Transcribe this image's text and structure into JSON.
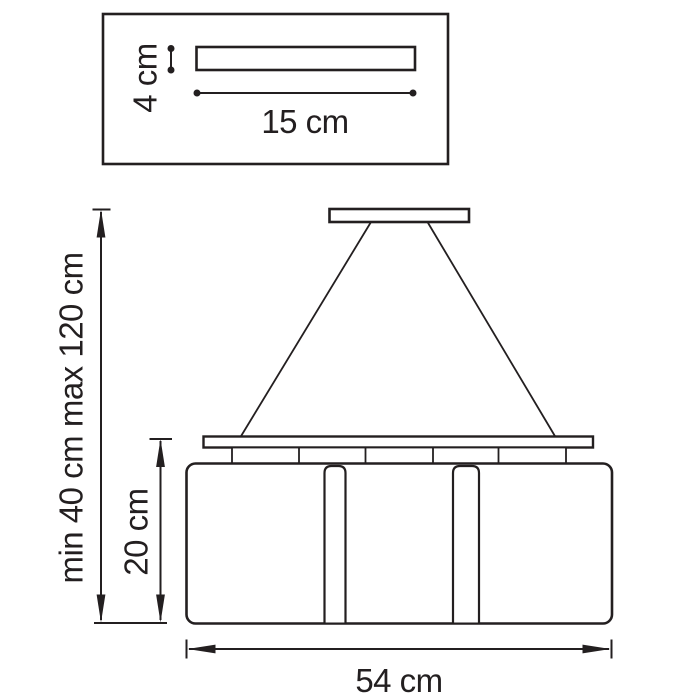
{
  "colors": {
    "line": "#231f20",
    "background": "#ffffff"
  },
  "detail_box": {
    "height_label": "4 cm",
    "width_label": "15 cm"
  },
  "main_view": {
    "suspension_height_label": "min 40 cm max 120 cm",
    "shade_height_label": "20 cm",
    "total_width_label": "54 cm"
  }
}
